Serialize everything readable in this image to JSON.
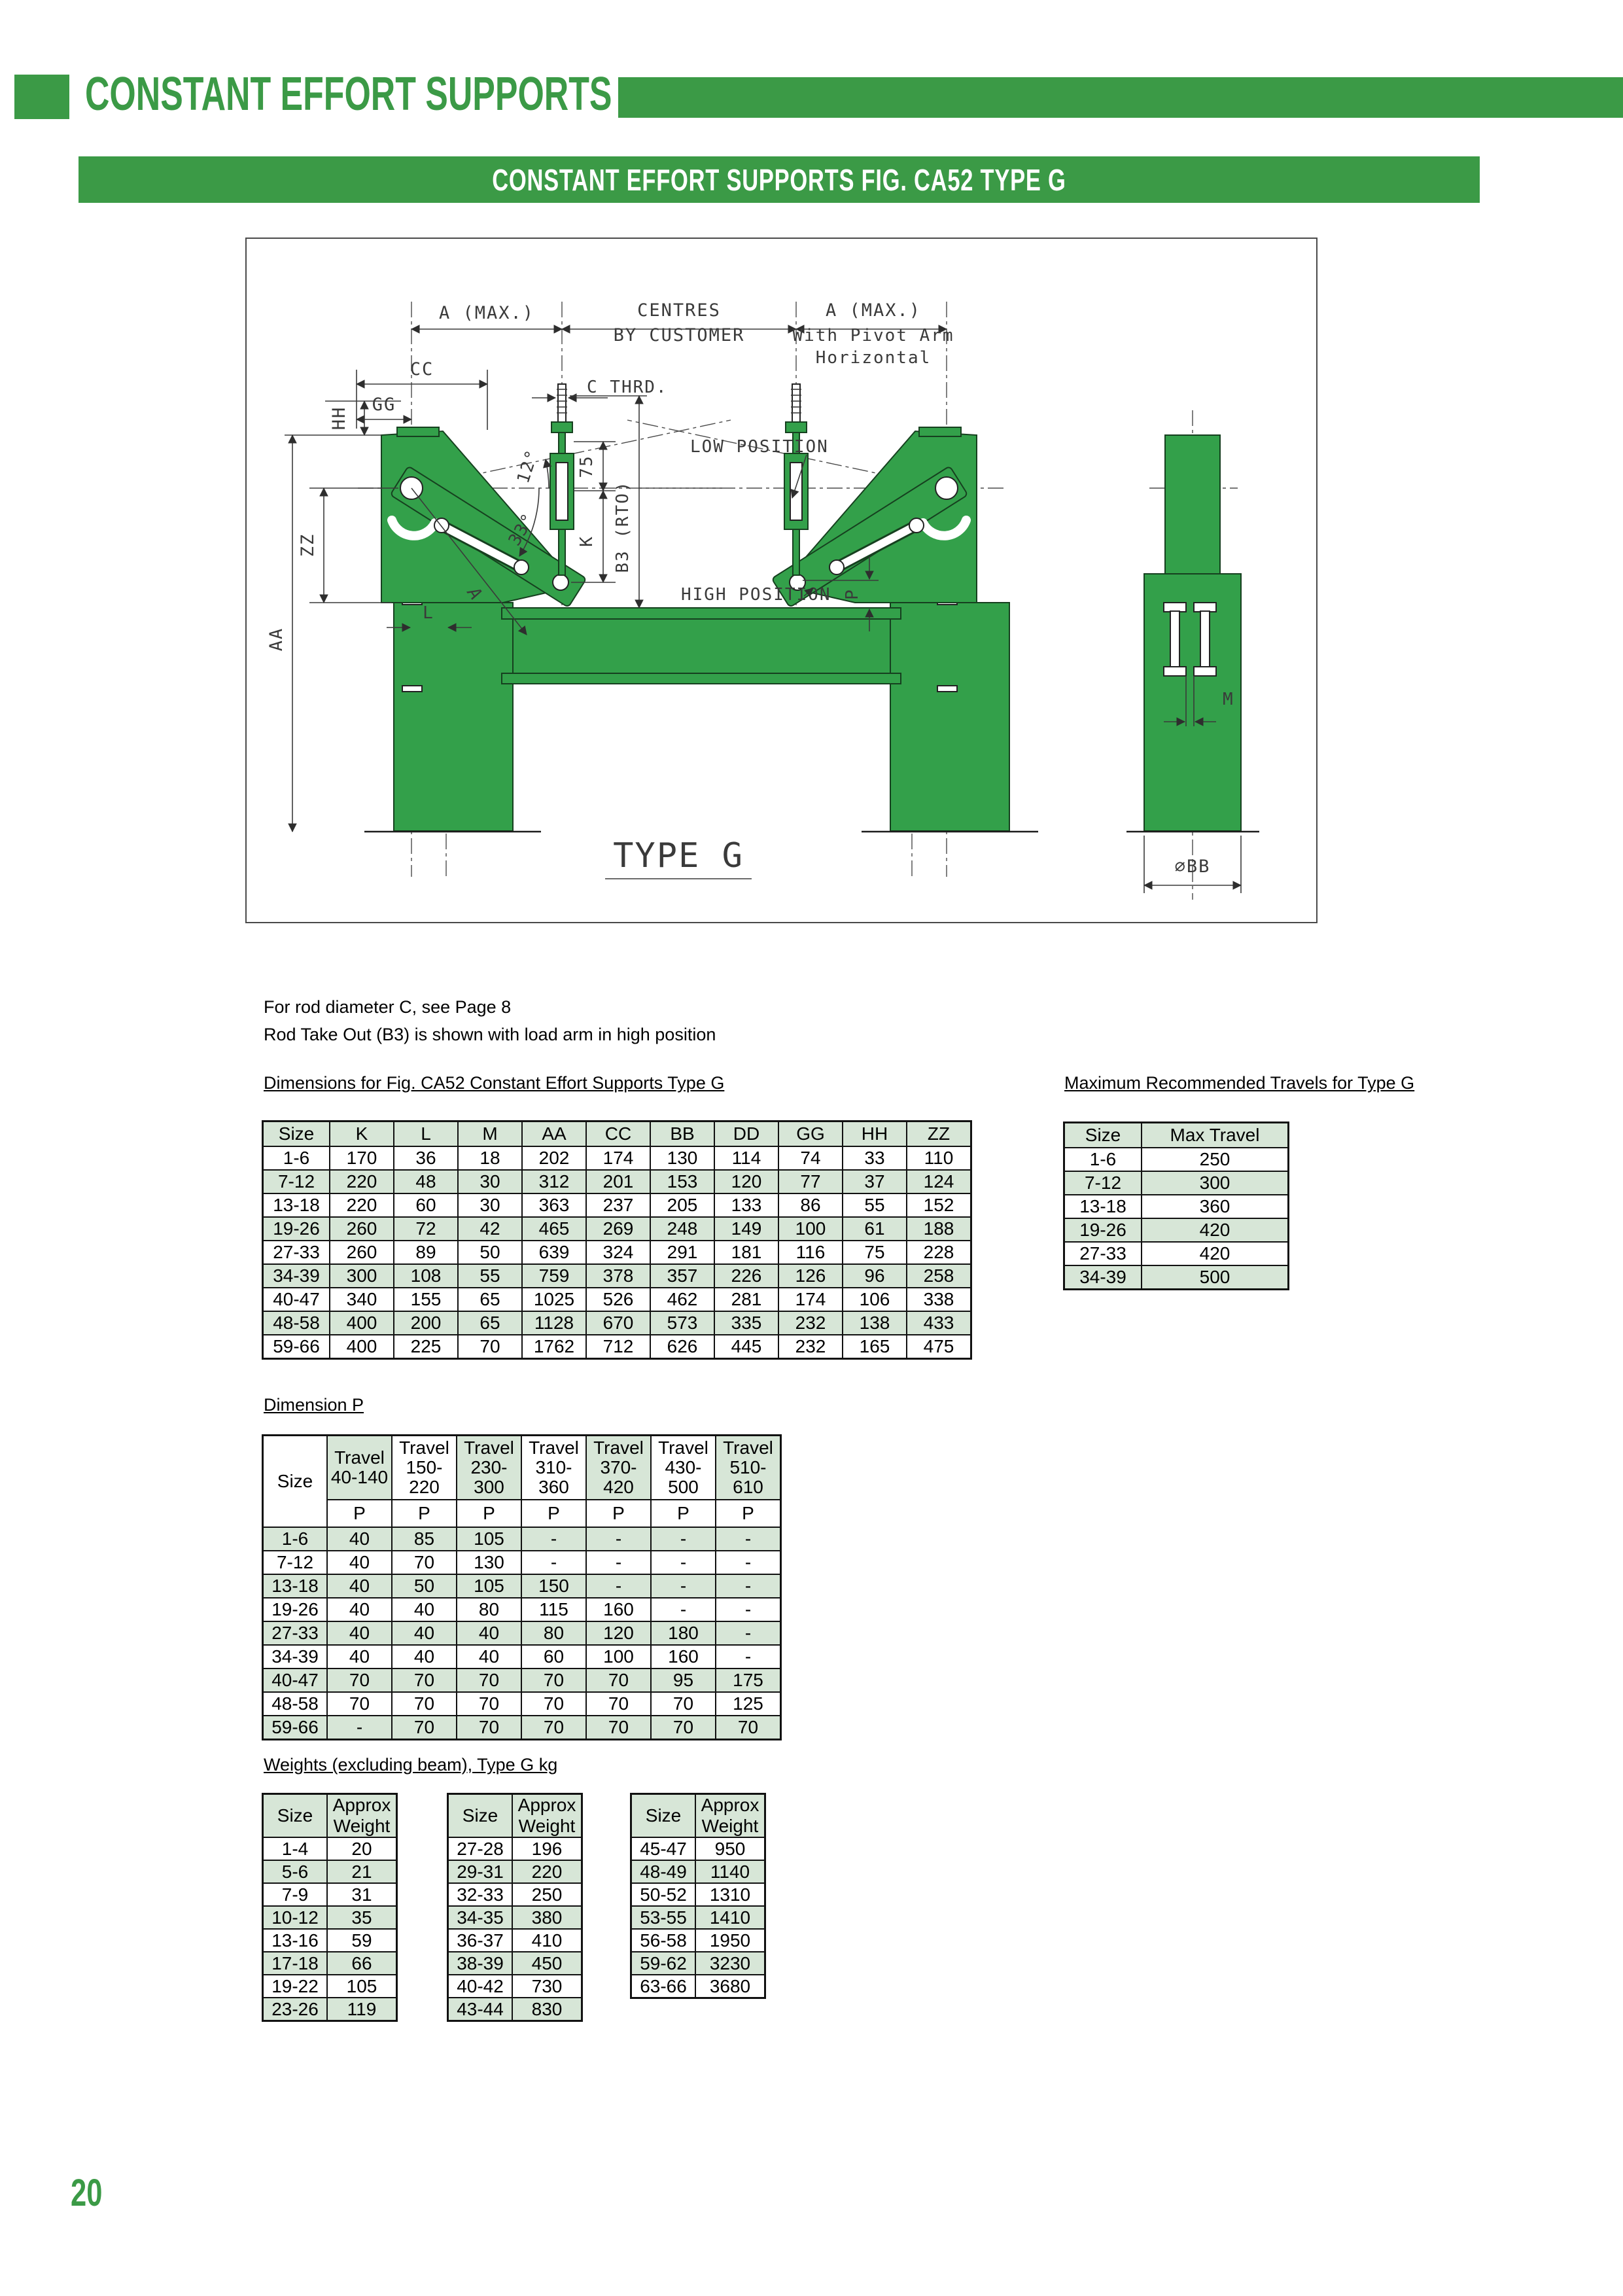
{
  "colors": {
    "accent_green": "#3b9a46",
    "drawing_green": "#33a04a",
    "table_stripe": "#d7e6d7"
  },
  "header": {
    "title": "CONSTANT EFFORT SUPPORTS",
    "banner": "CONSTANT EFFORT SUPPORTS FIG. CA52 TYPE G"
  },
  "notes": {
    "line1": "For rod diameter C, see Page 8",
    "line2": "Rod Take Out (B3) is shown with load arm in high position"
  },
  "drawing": {
    "labels": {
      "a_max_left": "A (MAX.)",
      "centres": "CENTRES",
      "by_customer": "BY CUSTOMER",
      "a_max_right": "A (MAX.)",
      "pivot_line1": "With Pivot Arm",
      "pivot_line2": "Horizontal",
      "cc": "CC",
      "gg": "GG",
      "hh": "HH",
      "zz": "ZZ",
      "aa": "AA",
      "c_thrd": "C THRD.",
      "low_position": "LOW POSITION",
      "high_position": "HIGH POSITION",
      "deg12": "12°",
      "deg33": "33°",
      "d75": "75",
      "k": "K",
      "b3": "B3 (RTO)",
      "l": "L",
      "a": "A",
      "p": "P",
      "m": "M",
      "bb": "⌀BB",
      "type_g": "TYPE G"
    }
  },
  "dimensions_table": {
    "title": "Dimensions for Fig. CA52 Constant Effort Supports Type G",
    "columns": [
      "Size",
      "K",
      "L",
      "M",
      "AA",
      "CC",
      "BB",
      "DD",
      "GG",
      "HH",
      "ZZ"
    ],
    "rows": [
      [
        "1-6",
        "170",
        "36",
        "18",
        "202",
        "174",
        "130",
        "114",
        "74",
        "33",
        "110"
      ],
      [
        "7-12",
        "220",
        "48",
        "30",
        "312",
        "201",
        "153",
        "120",
        "77",
        "37",
        "124"
      ],
      [
        "13-18",
        "220",
        "60",
        "30",
        "363",
        "237",
        "205",
        "133",
        "86",
        "55",
        "152"
      ],
      [
        "19-26",
        "260",
        "72",
        "42",
        "465",
        "269",
        "248",
        "149",
        "100",
        "61",
        "188"
      ],
      [
        "27-33",
        "260",
        "89",
        "50",
        "639",
        "324",
        "291",
        "181",
        "116",
        "75",
        "228"
      ],
      [
        "34-39",
        "300",
        "108",
        "55",
        "759",
        "378",
        "357",
        "226",
        "126",
        "96",
        "258"
      ],
      [
        "40-47",
        "340",
        "155",
        "65",
        "1025",
        "526",
        "462",
        "281",
        "174",
        "106",
        "338"
      ],
      [
        "48-58",
        "400",
        "200",
        "65",
        "1128",
        "670",
        "573",
        "335",
        "232",
        "138",
        "433"
      ],
      [
        "59-66",
        "400",
        "225",
        "70",
        "1762",
        "712",
        "626",
        "445",
        "232",
        "165",
        "475"
      ]
    ]
  },
  "travels_table": {
    "title": "Maximum Recommended Travels for Type G",
    "columns": [
      "Size",
      "Max Travel"
    ],
    "rows": [
      [
        "1-6",
        "250"
      ],
      [
        "7-12",
        "300"
      ],
      [
        "13-18",
        "360"
      ],
      [
        "19-26",
        "420"
      ],
      [
        "27-33",
        "420"
      ],
      [
        "34-39",
        "500"
      ]
    ]
  },
  "dimension_p_table": {
    "title": "Dimension P",
    "corner": "Size",
    "travel_headers": [
      "Travel\n40-140",
      "Travel\n150-\n220",
      "Travel\n230-\n300",
      "Travel\n310-\n360",
      "Travel\n370-\n420",
      "Travel\n430-\n500",
      "Travel\n510-\n610"
    ],
    "p_label": "P",
    "rows": [
      [
        "1-6",
        "40",
        "85",
        "105",
        "-",
        "-",
        "-",
        "-"
      ],
      [
        "7-12",
        "40",
        "70",
        "130",
        "-",
        "-",
        "-",
        "-"
      ],
      [
        "13-18",
        "40",
        "50",
        "105",
        "150",
        "-",
        "-",
        "-"
      ],
      [
        "19-26",
        "40",
        "40",
        "80",
        "115",
        "160",
        "-",
        "-"
      ],
      [
        "27-33",
        "40",
        "40",
        "40",
        "80",
        "120",
        "180",
        "-"
      ],
      [
        "34-39",
        "40",
        "40",
        "40",
        "60",
        "100",
        "160",
        "-"
      ],
      [
        "40-47",
        "70",
        "70",
        "70",
        "70",
        "70",
        "95",
        "175"
      ],
      [
        "48-58",
        "70",
        "70",
        "70",
        "70",
        "70",
        "70",
        "125"
      ],
      [
        "59-66",
        "-",
        "70",
        "70",
        "70",
        "70",
        "70",
        "70"
      ]
    ]
  },
  "weights": {
    "title": "Weights (excluding beam), Type G kg",
    "col_size": "Size",
    "col_weight": "Approx Weight",
    "tables": [
      [
        [
          "1-4",
          "20"
        ],
        [
          "5-6",
          "21"
        ],
        [
          "7-9",
          "31"
        ],
        [
          "10-12",
          "35"
        ],
        [
          "13-16",
          "59"
        ],
        [
          "17-18",
          "66"
        ],
        [
          "19-22",
          "105"
        ],
        [
          "23-26",
          "119"
        ]
      ],
      [
        [
          "27-28",
          "196"
        ],
        [
          "29-31",
          "220"
        ],
        [
          "32-33",
          "250"
        ],
        [
          "34-35",
          "380"
        ],
        [
          "36-37",
          "410"
        ],
        [
          "38-39",
          "450"
        ],
        [
          "40-42",
          "730"
        ],
        [
          "43-44",
          "830"
        ]
      ],
      [
        [
          "45-47",
          "950"
        ],
        [
          "48-49",
          "1140"
        ],
        [
          "50-52",
          "1310"
        ],
        [
          "53-55",
          "1410"
        ],
        [
          "56-58",
          "1950"
        ],
        [
          "59-62",
          "3230"
        ],
        [
          "63-66",
          "3680"
        ]
      ]
    ]
  },
  "page": {
    "number": "20"
  }
}
